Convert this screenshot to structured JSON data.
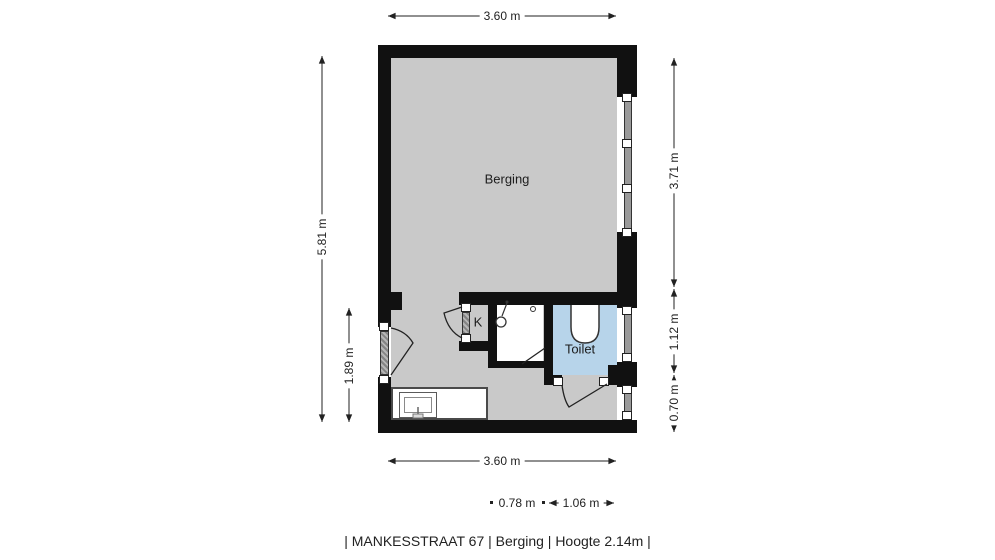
{
  "plan": {
    "rooms": {
      "berging": {
        "label": "Berging"
      },
      "toilet": {
        "label": "Toilet"
      },
      "closet": {
        "label": "K"
      }
    },
    "dimensions": {
      "top_width": "3.60 m",
      "left_total": "5.81 m",
      "left_lower": "1.89 m",
      "right_upper": "3.71 m",
      "right_middle": "1.12 m",
      "right_lower": "0.70 m",
      "bottom_width": "3.60 m",
      "bottom_left_segment": "0.78 m",
      "bottom_right_segment": "1.06 m"
    },
    "colors": {
      "wall": "#111111",
      "berging_floor": "#c9c9c9",
      "toilet_floor": "#b7d4ea",
      "shower_floor": "#ffffff",
      "window_glass": "#9a9a9a",
      "dimension_text": "#222222",
      "background": "#ffffff"
    }
  },
  "footer": {
    "caption": "| MANKESSTRAAT 67 | Berging | Hoogte 2.14m |"
  }
}
